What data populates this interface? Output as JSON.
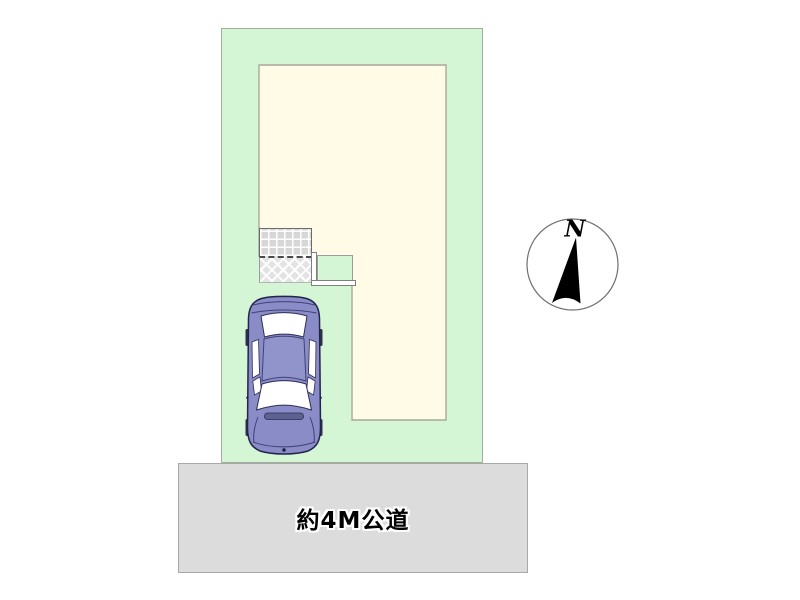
{
  "road": {
    "label": "約4M公道"
  },
  "compass": {
    "north_label": "N"
  },
  "colors": {
    "plot_green": "#d4f6d4",
    "building_ivory": "#fffbe6",
    "road_gray": "#dcdcdc",
    "tile_gray": "#d7d7d7",
    "car_body_purple": "#898cc6",
    "needle_black": "#000000"
  },
  "icons": {
    "car": "car-top-view",
    "compass_needle": "north-arrow",
    "entrance_tiles": "tile-grid-pattern",
    "entrance_hatch": "crosshatch-pattern"
  }
}
